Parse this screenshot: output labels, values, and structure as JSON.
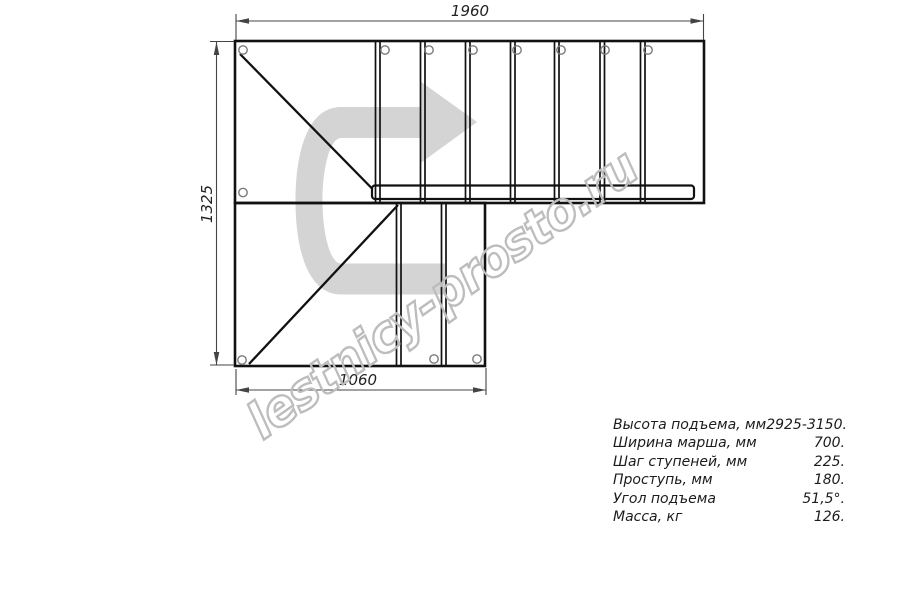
{
  "dimensions": {
    "top_width_mm": "1960",
    "left_height_mm": "1325",
    "bottom_width_mm": "1060"
  },
  "watermark": {
    "text": "lestnicy-prosto.ru",
    "outline_color": "#bdbdbd"
  },
  "direction_arrow": {
    "color": "#d4d4d4"
  },
  "colors": {
    "background": "#ffffff",
    "drawing_line": "#111111",
    "dimension_line": "#444444",
    "hole_outline": "#7a7a7a"
  },
  "specs": {
    "rows": [
      {
        "label": "Высота подъема, мм",
        "value": "2925-3150."
      },
      {
        "label": "Ширина марша, мм",
        "value": "700."
      },
      {
        "label": "Шаг ступеней, мм",
        "value": "225."
      },
      {
        "label": "Проступь, мм",
        "value": "180."
      },
      {
        "label": "Угол подъема",
        "value": "51,5°."
      },
      {
        "label": "Масса, кг",
        "value": "126."
      }
    ]
  }
}
